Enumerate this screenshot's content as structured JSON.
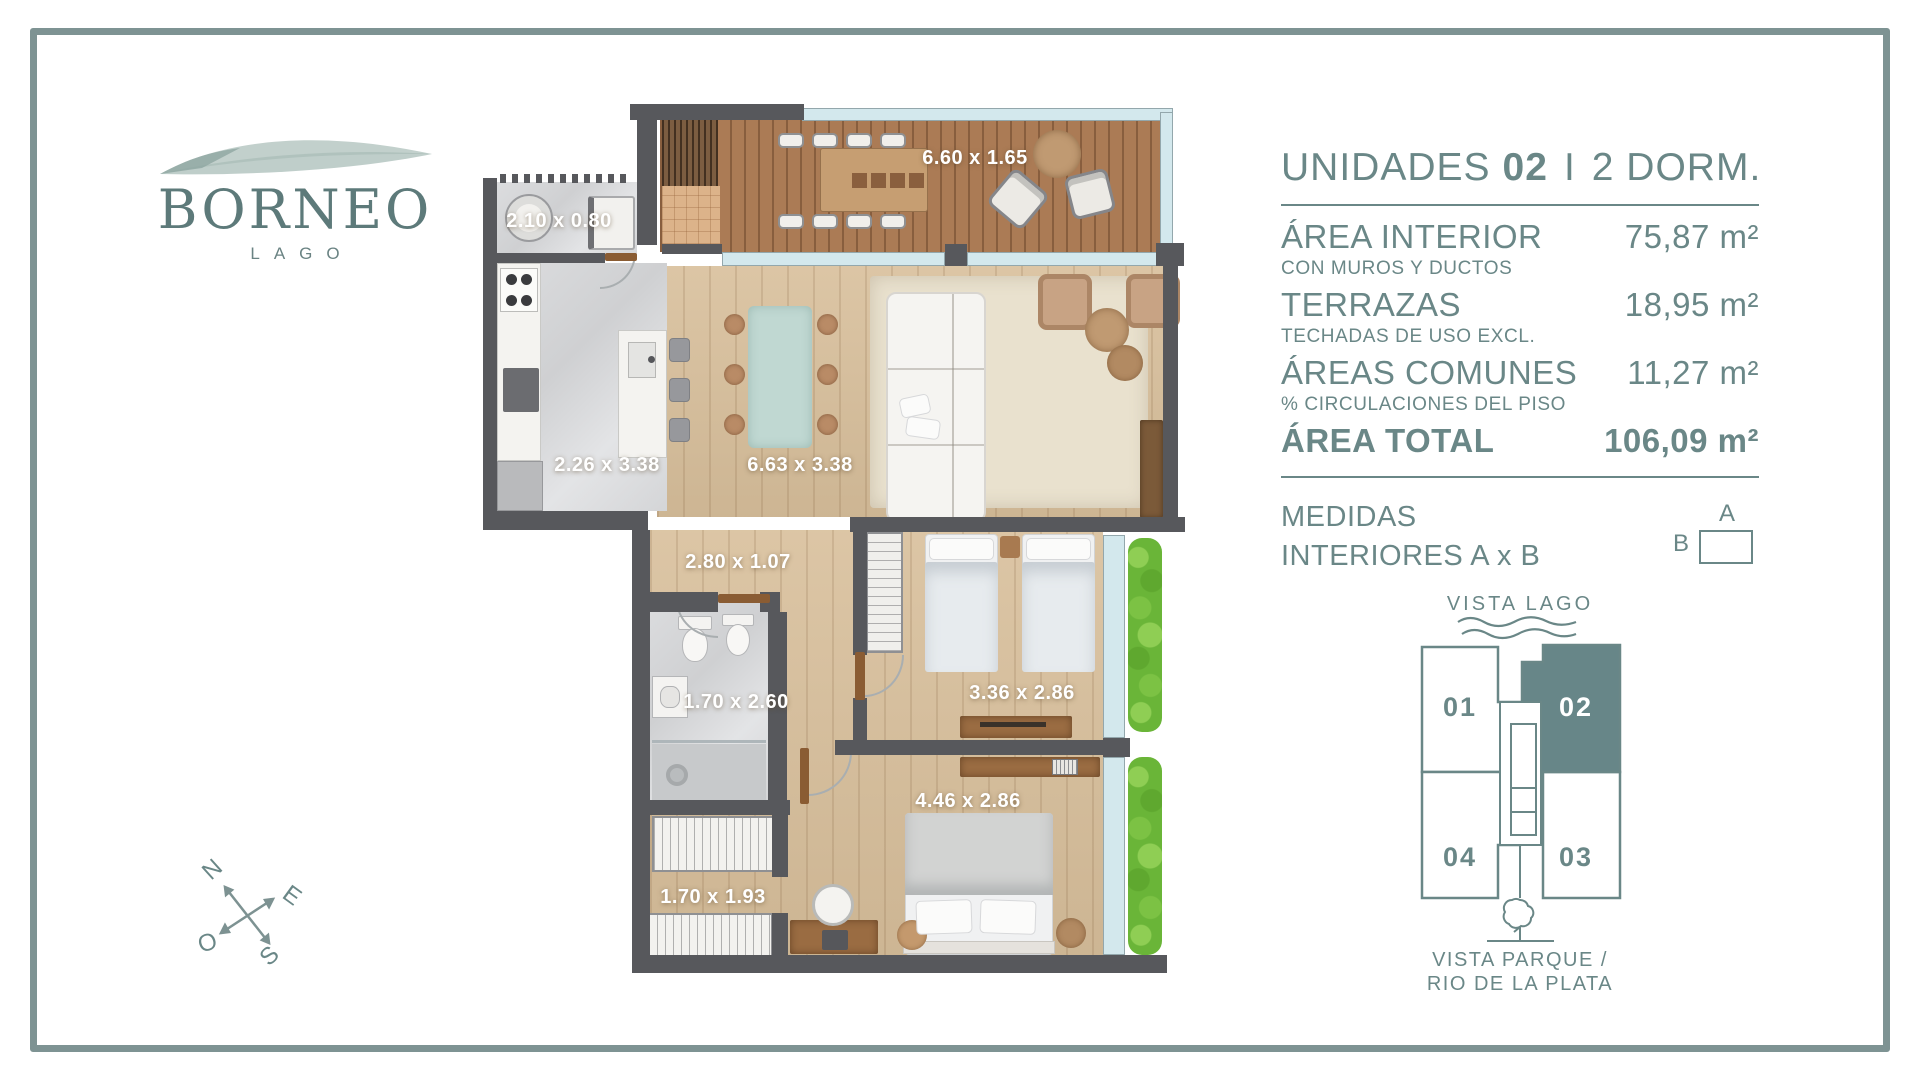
{
  "logo": {
    "name": "BORNEO",
    "tagline": "LAGO"
  },
  "panel": {
    "title": {
      "prefix": "UNIDADES",
      "unit": "02",
      "separator": "I",
      "suffix": "2 DORM."
    },
    "rows": [
      {
        "label": "ÁREA INTERIOR",
        "value": "75,87 m²",
        "note": "CON MUROS Y DUCTOS"
      },
      {
        "label": "TERRAZAS",
        "value": "18,95 m²",
        "note": "TECHADAS DE USO EXCL."
      },
      {
        "label": "ÁREAS COMUNES",
        "value": "11,27 m²",
        "note": "% CIRCULACIONES DEL PISO"
      },
      {
        "label": "ÁREA TOTAL",
        "value": "106,09 m²"
      }
    ],
    "medidas_line1": "MEDIDAS",
    "medidas_line2": "INTERIORES A x B",
    "diagram": {
      "a": "A",
      "b": "B"
    }
  },
  "keyplan": {
    "top_label": "VISTA LAGO",
    "bottom_label_line1": "VISTA PARQUE /",
    "bottom_label_line2": "RIO DE LA PLATA",
    "units": [
      {
        "id": "01",
        "highlighted": false
      },
      {
        "id": "02",
        "highlighted": true
      },
      {
        "id": "03",
        "highlighted": false
      },
      {
        "id": "04",
        "highlighted": false
      }
    ]
  },
  "compass": {
    "north": "N",
    "east": "E",
    "south": "S",
    "west": "O"
  },
  "floorplan": {
    "labels": [
      {
        "room": "terraza",
        "text": "6.60 x 1.65"
      },
      {
        "room": "lavadero",
        "text": "2.10 x 0.80"
      },
      {
        "room": "cocina",
        "text": "2.26 x 3.38"
      },
      {
        "room": "living-comedor",
        "text": "6.63 x 3.38"
      },
      {
        "room": "hall",
        "text": "2.80 x 1.07"
      },
      {
        "room": "bano",
        "text": "1.70 x 2.60"
      },
      {
        "room": "dormitorio-2",
        "text": "3.36 x 2.86"
      },
      {
        "room": "dormitorio-principal",
        "text": "4.46 x 2.86"
      },
      {
        "room": "vestidor",
        "text": "1.70 x 1.93"
      }
    ]
  },
  "colors": {
    "accent_teal": "#6a8787",
    "frame_border": "#7e9393",
    "wall_gray": "#57585c",
    "highlighted_unit_fill": "#678688",
    "plant_green": "#6ab538"
  }
}
